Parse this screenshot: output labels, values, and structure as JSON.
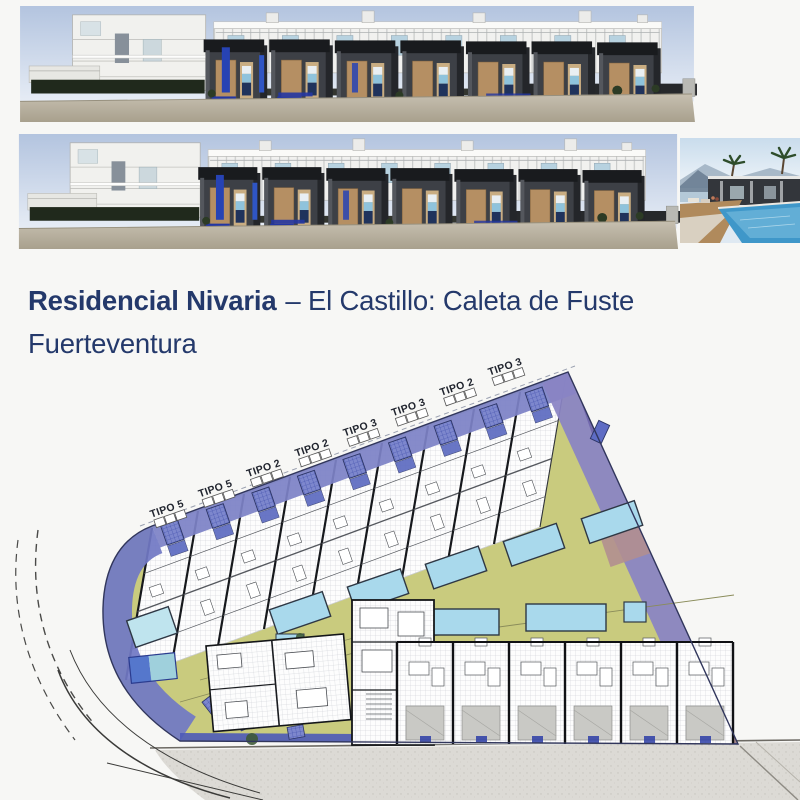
{
  "title": {
    "main": "Residencial Nivaria",
    "subtitle": "– El Castillo: Caleta de Fuste",
    "line2": "Fuerteventura"
  },
  "site_plan": {
    "unit_labels": [
      "TIPO 5",
      "TIPO 5",
      "TIPO 2",
      "TIPO 2",
      "TIPO 3",
      "TIPO 3",
      "TIPO 2",
      "TIPO 3"
    ]
  },
  "colors": {
    "title_navy": "#24396b",
    "road_purple": "#7d83c6",
    "garden_olive": "#c9cb7e",
    "pool_cyan": "#a9d9ec",
    "mauve": "#b18f90",
    "street_gray": "#dcdad5",
    "sky_blue": "#b3c4df",
    "facade_dark": "#3d4046",
    "door_tan": "#b58f63"
  }
}
